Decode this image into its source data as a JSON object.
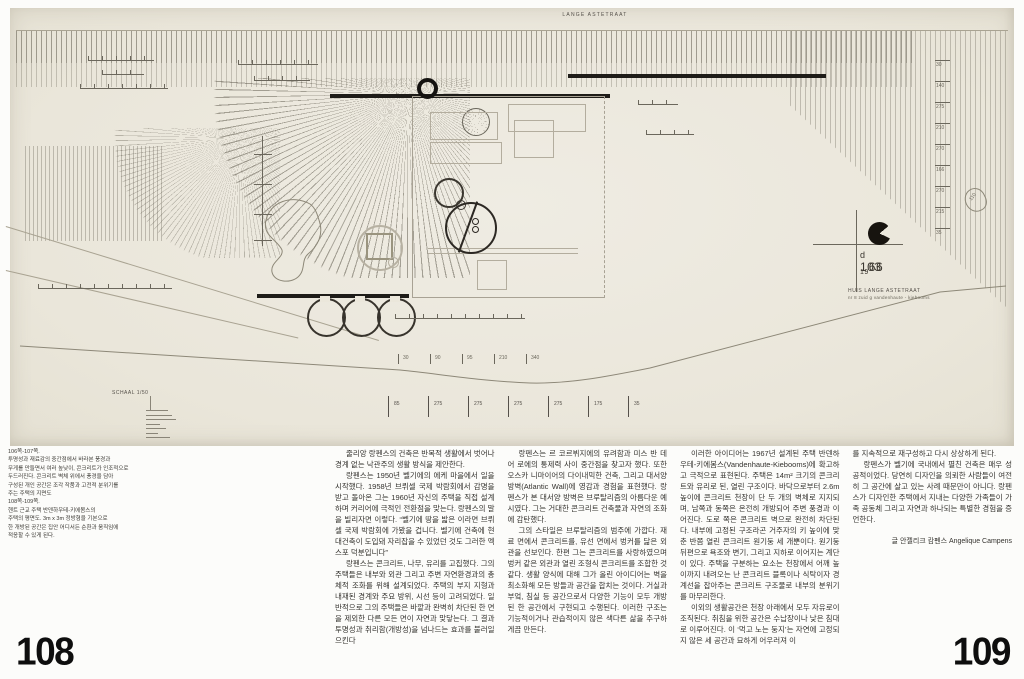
{
  "paper": {
    "street_label": "LANGE ASTETRAAT",
    "scale_label": "SCHAAL 1/50",
    "pond_label": "110",
    "stamp": {
      "d": "d",
      "num": "103",
      "sub": "19",
      "year": "66",
      "title": "HUIS  LANGE ASTETRAAT",
      "subtitle": "nr 8 zuid g  vandenhaute - kiebooms"
    },
    "dims_right": [
      "30",
      "140",
      "275",
      "210",
      "270",
      "166",
      "270",
      "215",
      "35"
    ],
    "dims_base": [
      "85",
      "275",
      "275",
      "275",
      "275",
      "175",
      "35"
    ],
    "dims_ground": [
      "30",
      "90",
      "95",
      "210",
      "340"
    ]
  },
  "caption": {
    "text": "106쪽-107쪽.\n투명성과 재료감의 중간점에서 바라본 풍경과\n무게를 만들면서 여러 높낮이, 콘크리트가 인조적으로\n두드러진다. 콘크리트 벽체 위에서 풍경을 담아\n구성된 개인 공간은 조각 작품과 고전적 분위기를\n주는 주택의 지면도\n108쪽-109쪽.\n헨트 근교 주택 반덴하우테-키에봄스의\n주택의 평면도. 3m x 3m 정방형을 기본으로\n한 개방된 공간은 집안 어디서든 순환과 움직임에\n적응할 수 있게 된다."
  },
  "article": {
    "col1": [
      "줄리앙 랑펜스의 건축은 반복적 생활에서 벗어나 경계 없는 낙관주의 생활 방식을 제안한다.",
      "랑펜스는 1950년 벨기에의 에케 마을에서 일을 시작했다. 1958년 브뤼셀 국제 박람회에서 감명을 받고 돌아온 그는 1960년 자신의 주택을 직접 설계하며 커리어에 극적인 전환점을 맞는다. 랑펜스의 말을 빌리자면 이렇다. “벨기에 땅을 밟은 이라면 브뤼셀 국제 박람회에 가봤을 겁니다. 벨기에 건축에 현대건축이 도입돼 자리잡을 수 있었던 것도 그러한 엑스포 덕분입니다”",
      "랑펜스는 콘크리트, 나무, 유리를 고집했다. 그의 주택들은 내부와 외관 그리고 주변 자연환경과의 총체적 조화를 위해 설계되었다. 주택의 부지 지형과 내재된 경계와 주요 방위, 시선 등이 고려되었다. 일반적으로 그의 주택들은 바깥과 완벽히 차단된 한 면을 제외한 다른 모든 면이 자연과 맞닿는다. 그 결과 투명성과 취리함(개방성)을 넘나드는 효과를 불러일으킨다"
    ],
    "col2": [
      "랑펜스는 르 코르뷔지에의 유려함과 미스 반 데어 로에의 통제력 사이 중간점을 찾고자 했다. 또한 오스카 니마이어의 다이내믹한 건축, 그리고 대서양 방벽(Atlantic Wall)에 영감과 경험을 표현했다. 랑펜스가 본 대서양 방벽은 브루탈리즘의 아름다운 예시였다. 그는 거대한 콘크리트 건축물과 자연의 조화에 감탄했다.",
      "그의 스타일은 브루탈리즘의 범주에 가깝다. 재료 면에서 콘크리트를, 유선 면에서 벙커를 닮은 외관을 선보인다. 한편 그는 콘크리트를 사랑하였으며 벙커 같은 외관과 열린 조형식 콘크리트를 조합한 것 같다. 생활 양식에 대해 그가 올린 아이디어는 벽을 최소화해 모든 방들과 공간을 합치는 것이다. 거실과 부엌, 침실 등 공간으로서 다양한 기능이 모두 개방된 한 공간에서 구현되고 수행된다. 이러한 구조는 기능적이거나 관습적이지 않은 색다른 삶을 추구하게끔 만든다."
    ],
    "col3": [
      "이러한 아이디어는 1967년 설계된 주택 반덴하우테-키에봄스(Vandenhaute-Kiebooms)에 확고하고 극적으로 표현된다. 주택은 14m² 크기의 콘크리트와 유리로 된, 열린 구조이다. 바닥으로부터 2.6m 높이에 콘크리트 천장이 단 두 개의 벽체로 지지되며, 남쪽과 동쪽은 온전히 개방되어 주변 풍경과 이어진다. 도로 쪽은 콘크리트 벽으로 완전히 차단된다. 내부에 고정된 구조라곤 거주자의 키 높이에 맞춘 반쯤 열린 콘크리트 원기둥 세 개뿐이다. 원기둥 뒤편으로 욕조와 변기, 그리고 지하로 이어지는 계단이 있다. 주택을 구분하는 요소는 천장에서 어깨 높이까지 내려오는 난 콘크리트 블록이나 식탁이자 경계선을 잡아주는 콘크리트 구조물로 내부의 분위기를 마무리한다.",
      "이외의 생활공간은 천장 아래에서 모두 자유로이 조직된다. 취침을 위한 공간은 수납장이나 낮은 침대로 이루어진다. 이 ‘먹고 노는 둥지’는 자연에 고정되지 않은 세 공간과 묘하게 어우러져 이"
    ],
    "col4": [
      "를 지속적으로 재구성하고 다시 상상하게 된다.",
      "랑펜스가 벨기에 국내에서 펼친 건축은 매우 성공적이었다. 당연히 디자인을 의뢰한 사람들이 여전히 그 공간에 살고 있는 사례 때문만이 아니다. 랑펜스가 디자인한 주택에서 지내는 다양한 가족들이 가족 공동체 그리고 자연과 하나되는 특별한 경험을 증언한다."
    ],
    "byline": "글 안젤리크 캄펜스 Angelique Campens"
  },
  "pages": {
    "left": "108",
    "right": "109"
  }
}
